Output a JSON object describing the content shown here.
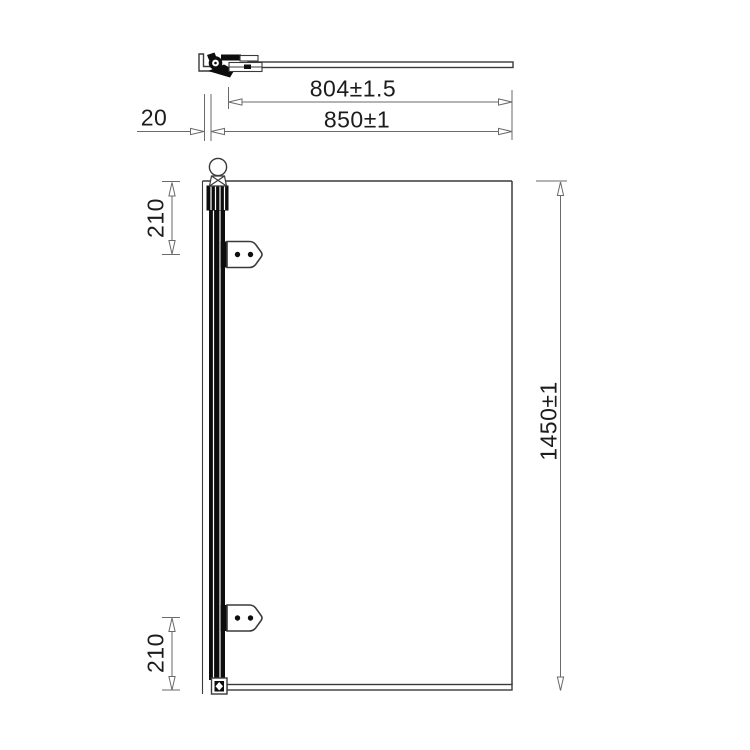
{
  "colors": {
    "drawing_line": "#3a3a3a",
    "dim_line": "#6a6a6a",
    "text_color": "#1c1c1c",
    "ink": "#0d0d0d",
    "bg": "#ffffff"
  },
  "dimensions": {
    "glass_width": {
      "label": "804±1.5"
    },
    "overall_width": {
      "label": "850±1"
    },
    "wall_gap": {
      "label": "20"
    },
    "top_hinge_offset": {
      "label": "210"
    },
    "overall_height": {
      "label": "1450±1"
    },
    "bottom_hinge_offset": {
      "label": "210"
    }
  }
}
